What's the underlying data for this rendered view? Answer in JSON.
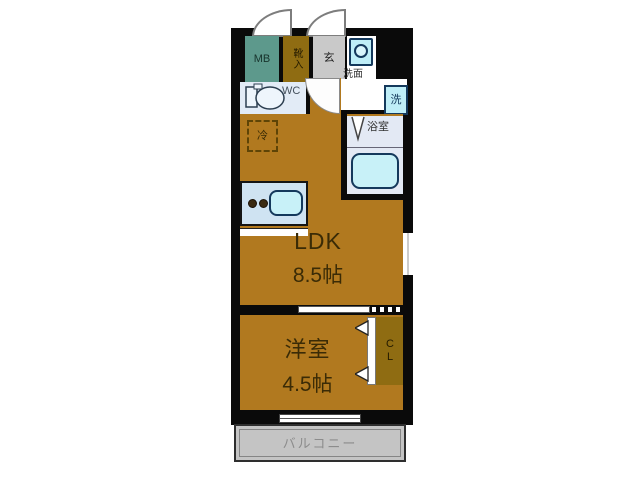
{
  "floorplan": {
    "ldk": {
      "name": "LDK",
      "size": "8.5帖"
    },
    "bedroom": {
      "name": "洋室",
      "size": "4.5帖"
    },
    "balcony": {
      "label": "バルコニー"
    },
    "bathroom": {
      "label": "浴室"
    },
    "wc": {
      "label": "WC"
    },
    "entrance": {
      "label": "玄"
    },
    "washroom": {
      "label": "洗面"
    },
    "meter_box": {
      "label": "MB"
    },
    "shoe_cabinet": {
      "label": "靴入"
    },
    "closet": {
      "label": "CL"
    },
    "washing_machine": {
      "label": "洗"
    },
    "refrigerator": {
      "label": "冷"
    },
    "colors": {
      "floor_brown": "#b1791f",
      "cabinet_mustard": "#8f6c12",
      "meter_box_teal": "#5d998c",
      "entrance_gray": "#c9c9c9",
      "balcony_gray": "#c4c4c4",
      "wet_room_blue": "#e2ebf6",
      "fixture_cyan": "#bfeef7",
      "counter_blue": "#cfe3f2",
      "wall_black": "#0a0a0a"
    }
  }
}
